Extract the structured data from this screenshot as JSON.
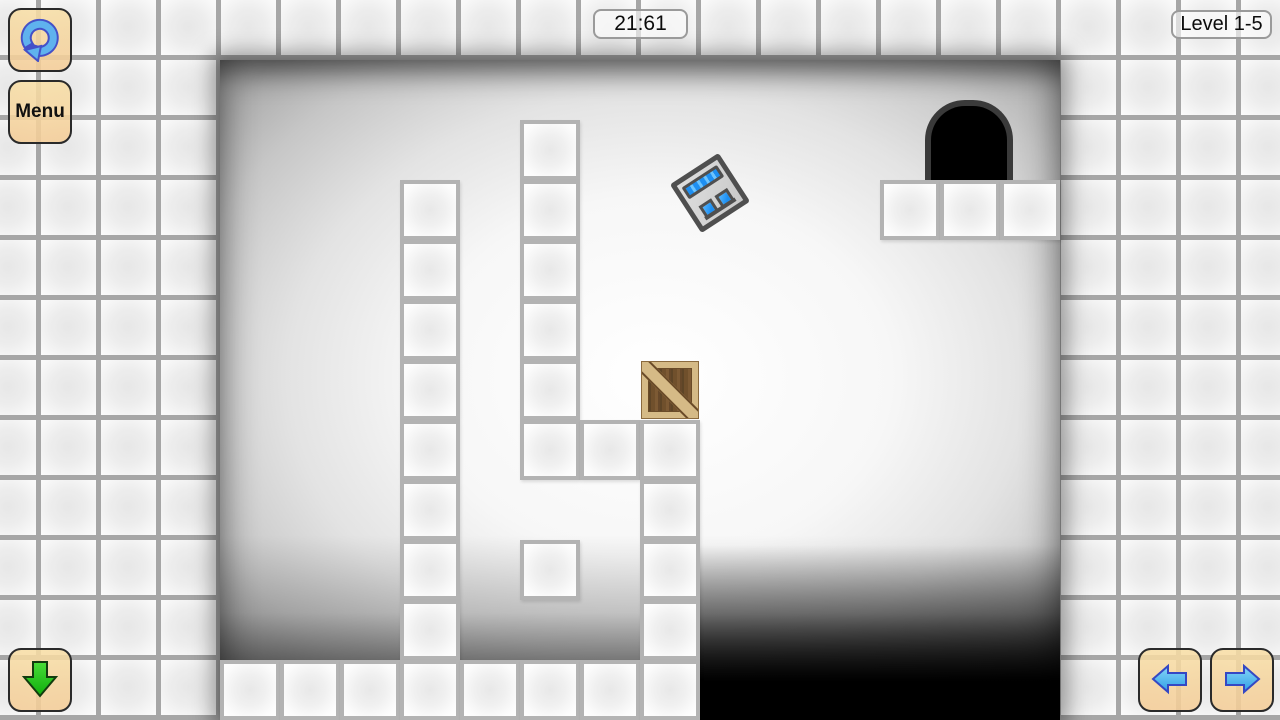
{
  "hud": {
    "timer": "21:61",
    "level_label": "Level 1-5",
    "menu_label": "Menu",
    "reset_icon": "restart-circular-arrow-icon",
    "down_icon": "green-down-arrow-icon",
    "prev_icon": "blue-left-arrow-icon",
    "next_icon": "blue-right-arrow-icon"
  },
  "palette": {
    "grid_gap": "#a6a6a6",
    "button_fill_top": "#f8dea4",
    "button_fill_bottom": "#f4cd98",
    "arrow_blue": "#55b6ee",
    "arrow_blue_outline": "#3448c4",
    "arrow_green": "#1ec717",
    "robot_blue": "#1d8ff2",
    "crate_frame": "#d5ba86",
    "crate_plank": "#70502c",
    "exit_fill": "#000000",
    "exit_outline": "#3a3a3a"
  },
  "level_map": {
    "origin_x": 220,
    "origin_y": 60,
    "cell": 60,
    "cols": 14,
    "rows": 11,
    "walls": [
      [
        3,
        2
      ],
      [
        3,
        3
      ],
      [
        3,
        4
      ],
      [
        3,
        5
      ],
      [
        3,
        6
      ],
      [
        3,
        7
      ],
      [
        3,
        8
      ],
      [
        3,
        9
      ],
      [
        5,
        1
      ],
      [
        5,
        2
      ],
      [
        5,
        3
      ],
      [
        5,
        4
      ],
      [
        5,
        5
      ],
      [
        5,
        6
      ],
      [
        6,
        6
      ],
      [
        7,
        6
      ],
      [
        7,
        7
      ],
      [
        7,
        8
      ],
      [
        7,
        9
      ],
      [
        5,
        8
      ],
      [
        11,
        2
      ],
      [
        12,
        2
      ],
      [
        13,
        2
      ],
      [
        0,
        10
      ],
      [
        1,
        10
      ],
      [
        2,
        10
      ],
      [
        3,
        10
      ],
      [
        4,
        10
      ],
      [
        5,
        10
      ],
      [
        6,
        10
      ],
      [
        7,
        10
      ]
    ],
    "crate_cell": [
      7,
      5
    ],
    "exit": {
      "x": 705,
      "y": 40,
      "w": 88,
      "h": 80
    },
    "robot": {
      "x": 461,
      "y": 104,
      "size": 58,
      "rotation_deg": -33
    }
  }
}
